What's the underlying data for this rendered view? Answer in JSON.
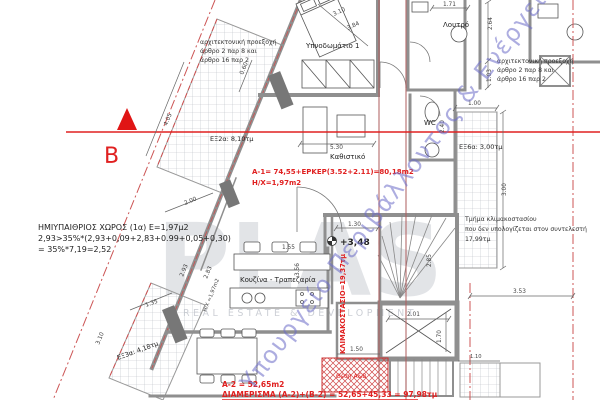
{
  "watermarks": {
    "ministry": "Υπουργείο Περιβάλλοντος & Ενέργειας",
    "logo_main": "PLAS",
    "logo_sub": "REAL ESTATE & DEVELOPMENT"
  },
  "section": {
    "label_b": "Β"
  },
  "rooms": {
    "bedroom1": "Υπνοδωμάτιο 1",
    "bathroom": "Λουτρό",
    "wc": "WC",
    "living": "Καθιστικό",
    "kitchen": "Κουζίνα - Τραπεζαρία"
  },
  "balconies": {
    "ex2a": "ΕΞ2α: 8,10τμ",
    "ex3a": "ΕΞ3α: 4,18τμ",
    "ex6a": "ΕΞ6α: 3,00τμ"
  },
  "red_annotations": {
    "a1_area": "Α-1= 74,55+ΕΡΚΕΡ(3.52+2.11)=80,18m2",
    "a1_hx": "Η/Χ=1,97m2",
    "staircase_area": "ΚΛΙΜΑΚΟΣΤΑΣΙΟ=19,37τμ",
    "a2_area": "Α-2 = 52,65m2",
    "apartment_total": "ΔΙΑΜΕΡΙΣΜΑ (Α-2)+(Β-2) = 52,65+45,33 = 97,98τμ",
    "parking_spot": "Θέση Α&Β"
  },
  "notes": {
    "arch_projection_1": "αρχιτεκτονική προεξοχή",
    "arch_projection_2": "άρθρο 2 παρ 8 και",
    "arch_projection_3": "άρθρο 16 παρ 2",
    "semi_open_1": "ΗΜΙΥΠΑΙΘΡΙΟΣ ΧΩΡΟΣ (1α)  Ε=1,97μ2",
    "semi_open_2": "2,93>35%*(2,93+0,09+2,83+0.99+0,05+0,30)",
    "semi_open_3": "= 35%*7,19=2,52",
    "stair_note_1": "Τμήμα κλιμακοστασίου",
    "stair_note_2": "που δεν υπολογίζεται στον συντελεστή",
    "stair_note_3": "17,99τμ"
  },
  "levels": {
    "floor_level": "+3,48"
  },
  "dims": {
    "d171": "1.71",
    "d264": "2.64",
    "d103": "1.03",
    "d100": "1.00",
    "d240": "2.40",
    "d530": "5.30",
    "d310a": "3.10",
    "d384": "3.84",
    "d060": "0.60",
    "d405": "4.05",
    "d200": "2.00",
    "d293": "2.93",
    "d283": "2.83",
    "dhx": "Η/Χ =1,97m2",
    "d135": "1.35",
    "d310b": "3.10",
    "d130": "1.30",
    "d285": "2.85",
    "d155": "1.55",
    "d356": "3.56",
    "d201": "2.01",
    "d170": "1.70",
    "d150": "1.50",
    "d353": "3.53",
    "d110": "1.10",
    "d300": "3.00"
  },
  "colors": {
    "red_annotation": "#e02020",
    "section_line": "#e02020",
    "boundary": "#cc5555",
    "wall": "#8f8f8f",
    "watermark_blue": "#6b6bc8"
  }
}
